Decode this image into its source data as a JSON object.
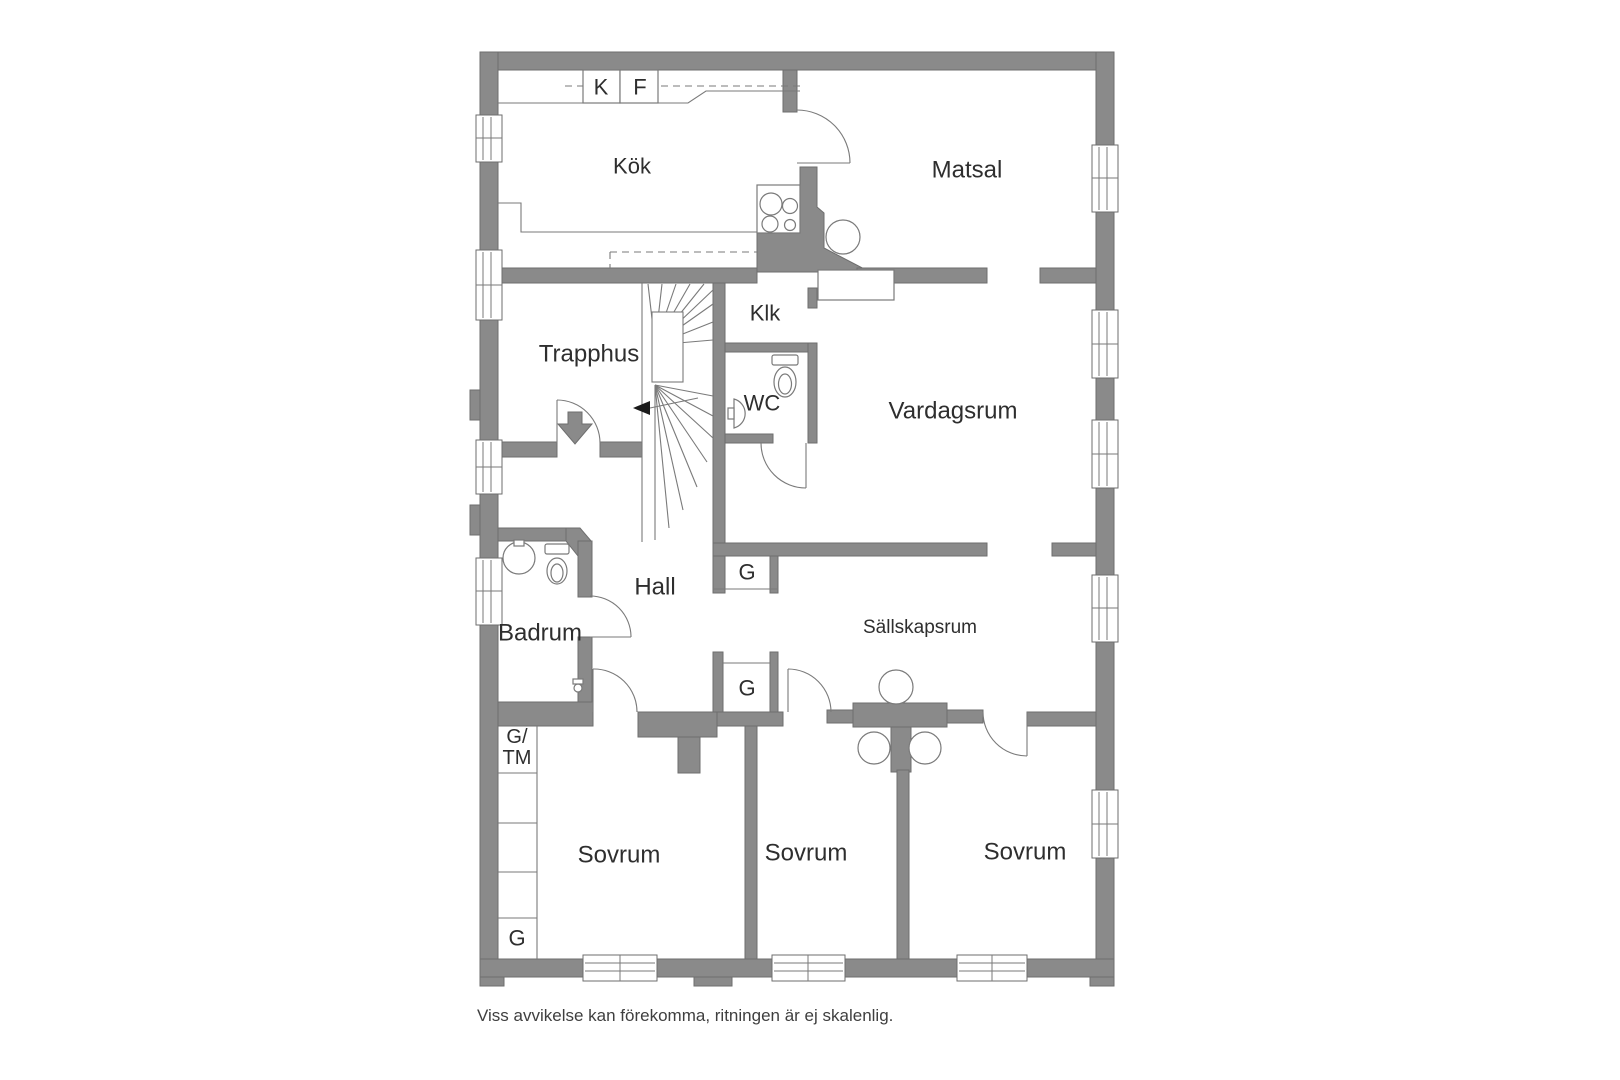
{
  "plan": {
    "rooms": {
      "kok": "Kök",
      "matsal": "Matsal",
      "trapphus": "Trapphus",
      "klk": "Klk",
      "wc": "WC",
      "vardagsrum": "Vardagsrum",
      "hall": "Hall",
      "badrum": "Badrum",
      "sallskapsrum": "Sällskapsrum",
      "sovrum1": "Sovrum",
      "sovrum2": "Sovrum",
      "sovrum3": "Sovrum"
    },
    "cabinets": {
      "k": "K",
      "f": "F"
    },
    "storage": {
      "g_hall_upper": "G",
      "g_hall_lower": "G",
      "g_tm_line1": "G/",
      "g_tm_line2": "TM",
      "g_sovrum": "G"
    },
    "disclaimer": "Viss avvikelse kan förekomma, ritningen är ej skalenlig.",
    "colors": {
      "wall": "#8a8a8a",
      "wall_outline": "#6e6e6e",
      "line": "#7a7a7a",
      "arrow": "#1a1a1a",
      "text": "#2e2e2e",
      "background": "#ffffff"
    }
  }
}
